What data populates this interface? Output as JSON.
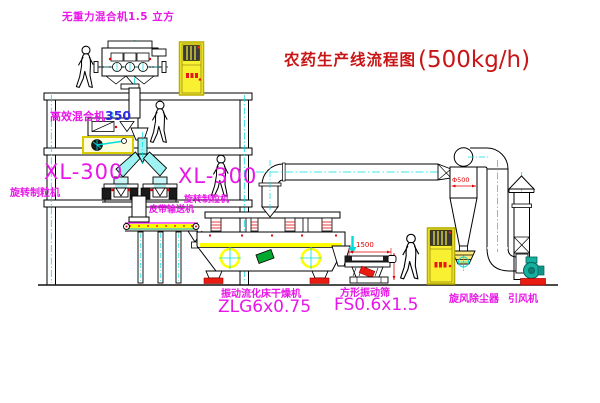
{
  "title": {
    "name": "农药生产线流程图",
    "capacity": "(500kg/h)"
  },
  "labels": {
    "top_mixer": "无重力混合机1.5 立方",
    "mixer2_name": "高效混合机",
    "mixer2_model": "350",
    "xl_left_model": "XL-300",
    "xl_left_name": "旋转制粒机",
    "xl_right_model": "XL-300",
    "xl_right_name": "旋转制粒机",
    "belt_conveyor": "皮带输送机",
    "dryer_name": "振动流化床干燥机",
    "dryer_model": "ZLG6x0.75",
    "sieve_name": "方形振动筛",
    "sieve_model": "FS0.6x1.5",
    "cyclone": "旋风除尘器",
    "fan": "引风机"
  },
  "dimensions": {
    "sieve_length": "1500",
    "cyclone_diameter": "Φ500"
  },
  "colors": {
    "label_magenta": "#e816e8",
    "title_red": "#c81616",
    "dim_red": "#e00000",
    "line_black": "#000000",
    "pipe_cyan": "#00dcdc",
    "fill_yellow": "#ffff00",
    "machine_green": "#00a830",
    "fan_teal": "#16ae9e",
    "base_red": "#ea1c12"
  }
}
